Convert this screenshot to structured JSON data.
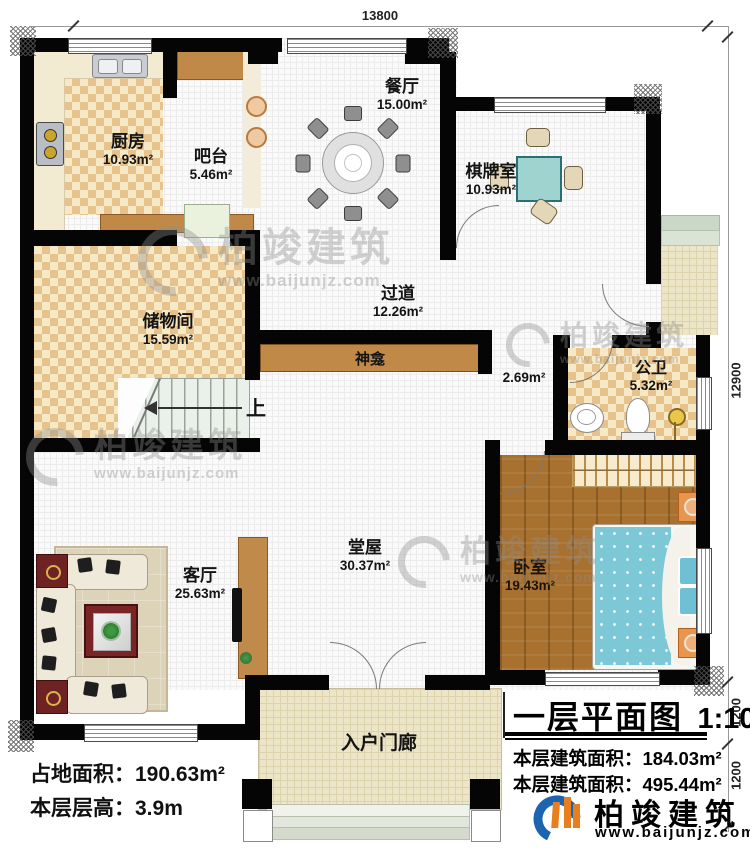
{
  "dims": {
    "top": "13800",
    "right": "12900",
    "right_sub1": "1200",
    "right_sub2": "1200"
  },
  "rooms": [
    {
      "name": "厨房",
      "area": "10.93m²"
    },
    {
      "name": "吧台",
      "area": "5.46m²"
    },
    {
      "name": "餐厅",
      "area": "15.00m²"
    },
    {
      "name": "棋牌室",
      "area": "10.93m²"
    },
    {
      "name": "储物间",
      "area": "15.59m²"
    },
    {
      "name": "过道",
      "area": "12.26m²"
    },
    {
      "name": "神龛",
      "area": "2.69m²"
    },
    {
      "name": "公卫",
      "area": "5.32m²"
    },
    {
      "name": "堂屋",
      "area": "30.37m²"
    },
    {
      "name": "客厅",
      "area": "25.63m²"
    },
    {
      "name": "卧室",
      "area": "19.43m²"
    },
    {
      "name": "入户门廊",
      "area": ""
    }
  ],
  "stairs": {
    "up_label": "上"
  },
  "stats": {
    "land_label": "占地面积：",
    "land_value": "190.63m²",
    "height_label": "本层层高：",
    "height_value": "3.9m"
  },
  "title_block": {
    "title": "一层平面图",
    "scale": "1:100",
    "area1_label": "本层建筑面积：",
    "area1_value": "184.03m²",
    "area2_label": "本层建筑面积：",
    "area2_value": "495.44m²"
  },
  "brand": {
    "name": "柏竣建筑",
    "url": "www.baijunjz.com"
  },
  "watermark": {
    "name": "柏竣建筑",
    "url": "www.baijunjz.com"
  },
  "colors": {
    "wall": "#050505",
    "tile_dark": "#e7c28b",
    "tile_light": "#f6e9c8",
    "wood": "#a8712f",
    "accent_brown": "#c08948",
    "teal": "#7cc8d6",
    "brand_blue": "#1c63b0",
    "brand_orange": "#e87f1e"
  }
}
